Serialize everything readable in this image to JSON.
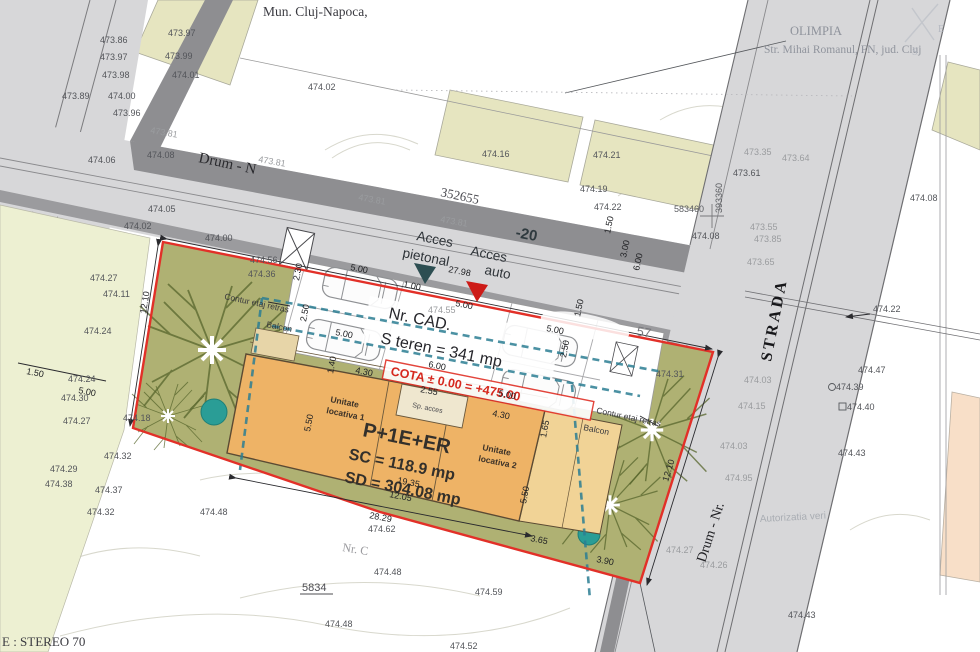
{
  "header": {
    "municipality": "Mun. Cluj-Napoca,",
    "site_name": "OLIMPIA",
    "site_address": "Str. Mihai Romanul, FN, jud. Cluj"
  },
  "roads": {
    "top_road": "Drum - N",
    "top_road_number": "352655",
    "top_road_badge": "-20",
    "strada": "STRADA",
    "bottom_road": "Drum - Nr."
  },
  "coords": {
    "x_label": "583460",
    "y_label": "393360",
    "system": "E : STEREO 70"
  },
  "access": {
    "pedestrian_1": "Acces",
    "pedestrian_2": "pietonal",
    "auto_1": "Acces",
    "auto_2": "auto"
  },
  "parcel": {
    "cad": "Nr. CAD.",
    "cad_suffix": "57",
    "area": "S teren = 341 mp",
    "cota": "COTA ± 0.00 = +475.00",
    "number": "5834",
    "nr_c": "Nr. C"
  },
  "building": {
    "unit1_l1": "Unitate",
    "unit1_l2": "locativa 1",
    "regime": "P+1E+ER",
    "sc": "SC = 118.9 mp",
    "sd": "SD = 304.08 mp",
    "unit2_l1": "Unitate",
    "unit2_l2": "locativa 2",
    "entrance": "Sp. acces"
  },
  "annotations": {
    "contur_left": "Contur etaj retras",
    "balcon_left": "Balcon",
    "contur_right": "Contur etaj retras",
    "balcon_right": "Balcon",
    "authorization": "Autorizatia veri",
    "compass_e": "E",
    "compass_s": "S"
  },
  "colors": {
    "boundary_red": "#e23028",
    "setback_teal": "#2c7e93",
    "bush_teal": "#2a9d96",
    "building_orange": "#eeb366",
    "terrace_orange": "#f1d396",
    "parcel_green": "#afb173",
    "road_gray": "#d7d7d9",
    "curb_gray": "#8e8e91",
    "adjacent_beige": "#e6e5c0",
    "pale_strip": "#edf0d2",
    "peach": "#f8dfc8",
    "arrow_pedestrian": "#2d4e52",
    "arrow_auto": "#cd1b17"
  },
  "spot_elevations": [
    {
      "v": "473.97",
      "x": 168,
      "y": 36
    },
    {
      "v": "473.86",
      "x": 100,
      "y": 43
    },
    {
      "v": "473.99",
      "x": 165,
      "y": 59
    },
    {
      "v": "473.97",
      "x": 100,
      "y": 60
    },
    {
      "v": "474.01",
      "x": 172,
      "y": 78
    },
    {
      "v": "473.98",
      "x": 102,
      "y": 78
    },
    {
      "v": "473.89",
      "x": 62,
      "y": 99
    },
    {
      "v": "474.00",
      "x": 108,
      "y": 99
    },
    {
      "v": "473.96",
      "x": 113,
      "y": 116
    },
    {
      "v": "473.81",
      "x": 150,
      "y": 133,
      "f": 1,
      "r": 10
    },
    {
      "v": "474.06",
      "x": 88,
      "y": 163
    },
    {
      "v": "474.08",
      "x": 147,
      "y": 158
    },
    {
      "v": "474.02",
      "x": 308,
      "y": 90
    },
    {
      "v": "474.16",
      "x": 482,
      "y": 157
    },
    {
      "v": "474.21",
      "x": 593,
      "y": 158
    },
    {
      "v": "474.19",
      "x": 580,
      "y": 192
    },
    {
      "v": "474.22",
      "x": 594,
      "y": 210
    },
    {
      "v": "474.08",
      "x": 692,
      "y": 239
    },
    {
      "v": "473.81",
      "x": 258,
      "y": 162,
      "f": 1,
      "r": 10
    },
    {
      "v": "473.81",
      "x": 358,
      "y": 200,
      "f": 1,
      "r": 10
    },
    {
      "v": "473.81",
      "x": 440,
      "y": 222,
      "f": 1,
      "r": 10
    },
    {
      "v": "474.05",
      "x": 148,
      "y": 212
    },
    {
      "v": "474.02",
      "x": 124,
      "y": 229
    },
    {
      "v": "474.27",
      "x": 90,
      "y": 281
    },
    {
      "v": "474.11",
      "x": 103,
      "y": 297
    },
    {
      "v": "474.24",
      "x": 84,
      "y": 334
    },
    {
      "v": "474.24",
      "x": 68,
      "y": 382
    },
    {
      "v": "474.30",
      "x": 61,
      "y": 401
    },
    {
      "v": "474.00",
      "x": 205,
      "y": 241
    },
    {
      "v": "474.56",
      "x": 250,
      "y": 263
    },
    {
      "v": "474.36",
      "x": 248,
      "y": 277
    },
    {
      "v": "474.31",
      "x": 656,
      "y": 377
    },
    {
      "v": "474.18",
      "x": 123,
      "y": 421
    },
    {
      "v": "474.27",
      "x": 63,
      "y": 424
    },
    {
      "v": "474.32",
      "x": 104,
      "y": 459
    },
    {
      "v": "474.29",
      "x": 50,
      "y": 472
    },
    {
      "v": "474.38",
      "x": 45,
      "y": 487
    },
    {
      "v": "474.37",
      "x": 95,
      "y": 493
    },
    {
      "v": "474.32",
      "x": 87,
      "y": 515
    },
    {
      "v": "474.48",
      "x": 200,
      "y": 515
    },
    {
      "v": "474.62",
      "x": 368,
      "y": 532
    },
    {
      "v": "474.48",
      "x": 374,
      "y": 575
    },
    {
      "v": "474.59",
      "x": 475,
      "y": 595
    },
    {
      "v": "474.48",
      "x": 325,
      "y": 627
    },
    {
      "v": "474.52",
      "x": 450,
      "y": 649
    },
    {
      "v": "473.35",
      "x": 744,
      "y": 155,
      "f": 1
    },
    {
      "v": "473.64",
      "x": 782,
      "y": 161,
      "f": 1
    },
    {
      "v": "473.61",
      "x": 733,
      "y": 176
    },
    {
      "v": "474.08",
      "x": 910,
      "y": 201
    },
    {
      "v": "473.55",
      "x": 750,
      "y": 230,
      "f": 1
    },
    {
      "v": "473.85",
      "x": 754,
      "y": 242,
      "f": 1
    },
    {
      "v": "473.65",
      "x": 747,
      "y": 265,
      "f": 1
    },
    {
      "v": "474.22",
      "x": 873,
      "y": 312
    },
    {
      "v": "474.47",
      "x": 858,
      "y": 373
    },
    {
      "v": "474.39",
      "x": 836,
      "y": 390
    },
    {
      "v": "474.40",
      "x": 847,
      "y": 410
    },
    {
      "v": "474.43",
      "x": 838,
      "y": 456
    },
    {
      "v": "474.43",
      "x": 788,
      "y": 618
    },
    {
      "v": "474.03",
      "x": 744,
      "y": 383,
      "f": 1
    },
    {
      "v": "474.15",
      "x": 738,
      "y": 409,
      "f": 1
    },
    {
      "v": "474.03",
      "x": 720,
      "y": 449,
      "f": 1
    },
    {
      "v": "474.95",
      "x": 725,
      "y": 481,
      "f": 1
    },
    {
      "v": "474.27",
      "x": 666,
      "y": 553,
      "f": 1
    },
    {
      "v": "474.26",
      "x": 700,
      "y": 568,
      "f": 1
    },
    {
      "v": "474.55",
      "x": 428,
      "y": 313,
      "f": 1
    }
  ],
  "dimensions": [
    {
      "v": "27.98",
      "x": 448,
      "y": 272,
      "r": 11
    },
    {
      "v": "1.00",
      "x": 403,
      "y": 287,
      "r": 11
    },
    {
      "v": "5.00",
      "x": 455,
      "y": 306,
      "r": 11
    },
    {
      "v": "5.00",
      "x": 350,
      "y": 270,
      "r": 11
    },
    {
      "v": "5.00",
      "x": 335,
      "y": 335,
      "r": 11
    },
    {
      "v": "5.00",
      "x": 546,
      "y": 331,
      "r": 11
    },
    {
      "v": "5.00",
      "x": 498,
      "y": 396,
      "r": 11
    },
    {
      "v": "6.00",
      "x": 428,
      "y": 367,
      "r": 11
    },
    {
      "v": "2.30",
      "x": 299,
      "y": 281,
      "r": -79
    },
    {
      "v": "2.50",
      "x": 306,
      "y": 322,
      "r": -79
    },
    {
      "v": "2.50",
      "x": 566,
      "y": 358,
      "r": -79
    },
    {
      "v": "1.40",
      "x": 333,
      "y": 374,
      "r": -79
    },
    {
      "v": "4.30",
      "x": 355,
      "y": 373,
      "r": 11
    },
    {
      "v": "4.30",
      "x": 492,
      "y": 416,
      "r": 11
    },
    {
      "v": "2.55",
      "x": 420,
      "y": 392,
      "r": 11
    },
    {
      "v": "5.50",
      "x": 310,
      "y": 432,
      "r": -79
    },
    {
      "v": "1.65",
      "x": 546,
      "y": 438,
      "r": -79
    },
    {
      "v": "5.50",
      "x": 526,
      "y": 504,
      "r": -79
    },
    {
      "v": "19.35",
      "x": 397,
      "y": 483,
      "r": 11
    },
    {
      "v": "12.05",
      "x": 389,
      "y": 497,
      "r": 11
    },
    {
      "v": "28.29",
      "x": 369,
      "y": 518,
      "r": 11
    },
    {
      "v": "3.65",
      "x": 530,
      "y": 541,
      "r": 11
    },
    {
      "v": "3.90",
      "x": 596,
      "y": 562,
      "r": 11
    },
    {
      "v": "12.10",
      "x": 146,
      "y": 314,
      "r": -81
    },
    {
      "v": "12.10",
      "x": 668,
      "y": 482,
      "r": -73
    },
    {
      "v": "1.50",
      "x": 26,
      "y": 374,
      "r": 11
    },
    {
      "v": "5.00",
      "x": 78,
      "y": 393,
      "r": 11
    },
    {
      "v": "1.50",
      "x": 610,
      "y": 234,
      "r": -78
    },
    {
      "v": "3.00",
      "x": 626,
      "y": 258,
      "r": -78
    },
    {
      "v": "6.00",
      "x": 639,
      "y": 271,
      "r": -78
    },
    {
      "v": "1.50",
      "x": 580,
      "y": 317,
      "r": -78
    }
  ]
}
